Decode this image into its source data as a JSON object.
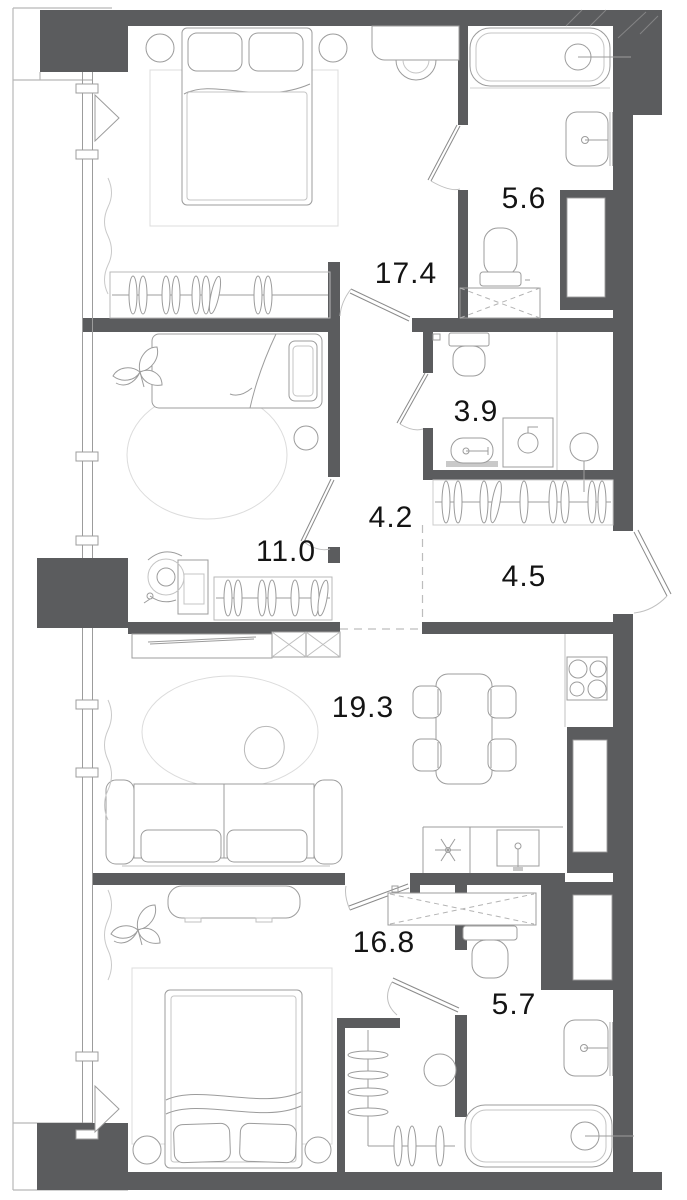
{
  "plan": {
    "rooms": [
      {
        "name": "bedroom-upper",
        "area": "17.4"
      },
      {
        "name": "bathroom-upper",
        "area": "5.6"
      },
      {
        "name": "wc",
        "area": "3.9"
      },
      {
        "name": "corridor",
        "area": "4.2"
      },
      {
        "name": "bedroom-middle",
        "area": "11.0"
      },
      {
        "name": "hallway",
        "area": "4.5"
      },
      {
        "name": "living-kitchen",
        "area": "19.3"
      },
      {
        "name": "bedroom-lower",
        "area": "16.8"
      },
      {
        "name": "bathroom-lower",
        "area": "5.7"
      }
    ],
    "colors": {
      "wall": "#5b5c5e",
      "furniture_line": "#9c9c9c",
      "light_line": "#d4d4d4",
      "label": "#141414",
      "background": "#ffffff"
    }
  }
}
